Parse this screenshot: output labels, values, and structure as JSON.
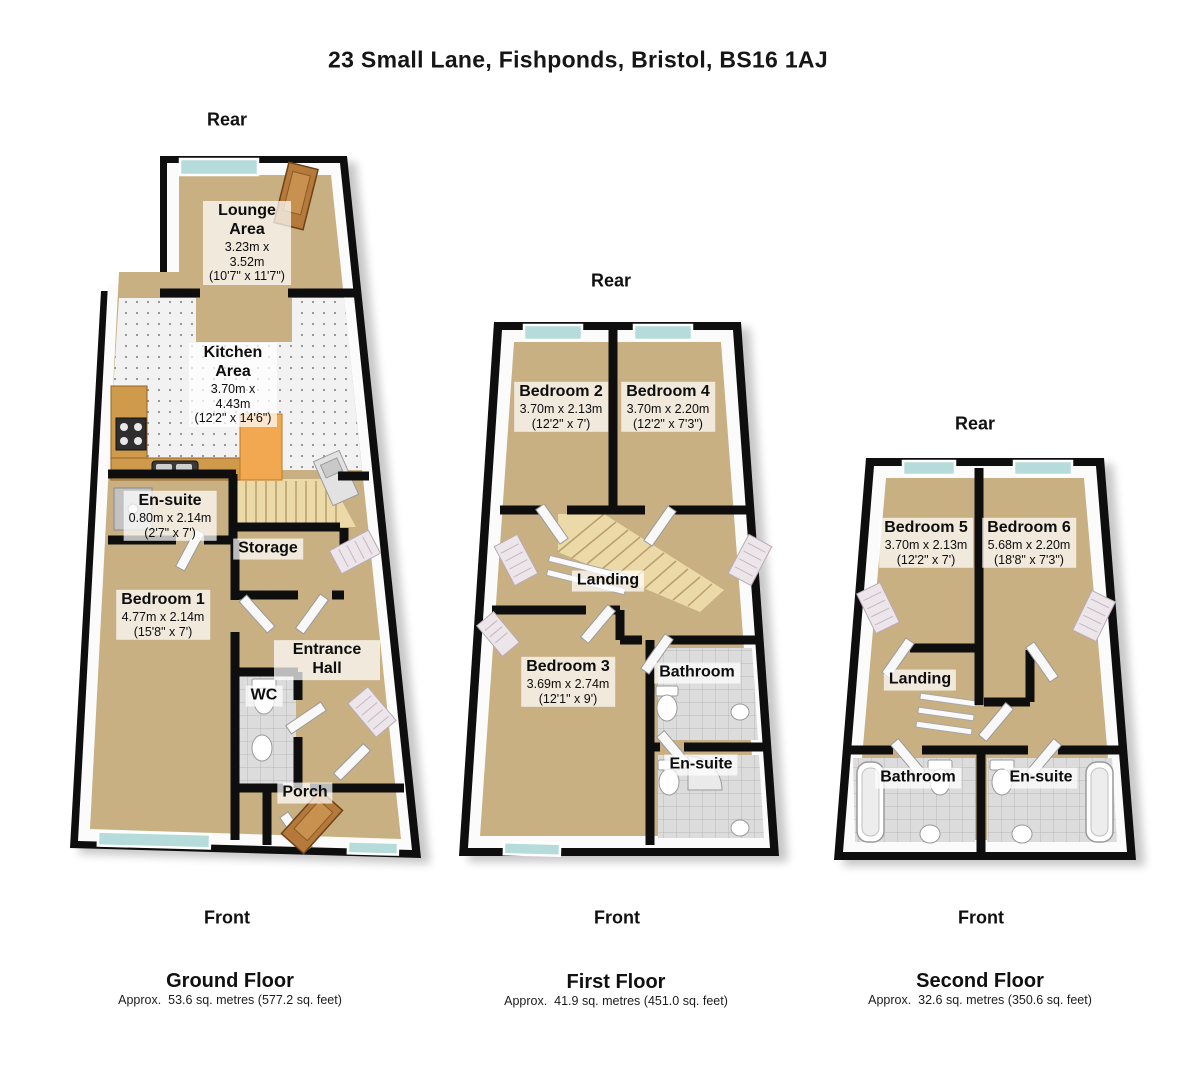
{
  "title": "23 Small Lane, Fishponds, Bristol, BS16 1AJ",
  "labels": {
    "rear": "Rear",
    "front": "Front"
  },
  "floors": {
    "ground": {
      "caption": "Ground Floor",
      "area": "Approx.  53.6 sq. metres (577.2 sq. feet)",
      "rooms": {
        "lounge": {
          "name": "Lounge Area",
          "metric": "3.23m x 3.52m",
          "imperial": "(10'7\" x 11'7\")"
        },
        "kitchen": {
          "name": "Kitchen Area",
          "metric": "3.70m x 4.43m",
          "imperial": "(12'2\" x 14'6\")"
        },
        "ensuite": {
          "name": "En-suite",
          "metric": "0.80m x 2.14m",
          "imperial": "(2'7\" x 7')"
        },
        "storage": {
          "name": "Storage"
        },
        "bedroom1": {
          "name": "Bedroom 1",
          "metric": "4.77m x 2.14m",
          "imperial": "(15'8\" x 7')"
        },
        "entrance_hall": {
          "name": "Entrance Hall"
        },
        "wc": {
          "name": "WC"
        },
        "porch": {
          "name": "Porch"
        }
      }
    },
    "first": {
      "caption": "First Floor",
      "area": "Approx.  41.9 sq. metres (451.0 sq. feet)",
      "rooms": {
        "bedroom2": {
          "name": "Bedroom 2",
          "metric": "3.70m x 2.13m",
          "imperial": "(12'2\" x 7')"
        },
        "bedroom4": {
          "name": "Bedroom 4",
          "metric": "3.70m x 2.20m",
          "imperial": "(12'2\" x 7'3\")"
        },
        "landing": {
          "name": "Landing"
        },
        "bedroom3": {
          "name": "Bedroom 3",
          "metric": "3.69m x 2.74m",
          "imperial": "(12'1\" x 9')"
        },
        "bathroom": {
          "name": "Bathroom"
        },
        "ensuite": {
          "name": "En-suite"
        }
      }
    },
    "second": {
      "caption": "Second Floor",
      "area": "Approx.  32.6 sq. metres (350.6 sq. feet)",
      "rooms": {
        "bedroom5": {
          "name": "Bedroom 5",
          "metric": "3.70m x 2.13m",
          "imperial": "(12'2\" x 7')"
        },
        "bedroom6": {
          "name": "Bedroom 6",
          "metric": "5.68m x 2.20m",
          "imperial": "(18'8\" x 7'3\")"
        },
        "landing": {
          "name": "Landing"
        },
        "bathroom": {
          "name": "Bathroom"
        },
        "ensuite": {
          "name": "En-suite"
        }
      }
    }
  },
  "colors": {
    "wall": "#0e0e0e",
    "floor_beige": "#c8b083",
    "window_glass": "#b5dcdb",
    "door_wood": "#b5793b",
    "stairs": "#ecd9a8",
    "kitchen_tile": "#f2f2f2",
    "bathroom_tile": "#dcdcdc",
    "island_wood": "#f2a851"
  }
}
